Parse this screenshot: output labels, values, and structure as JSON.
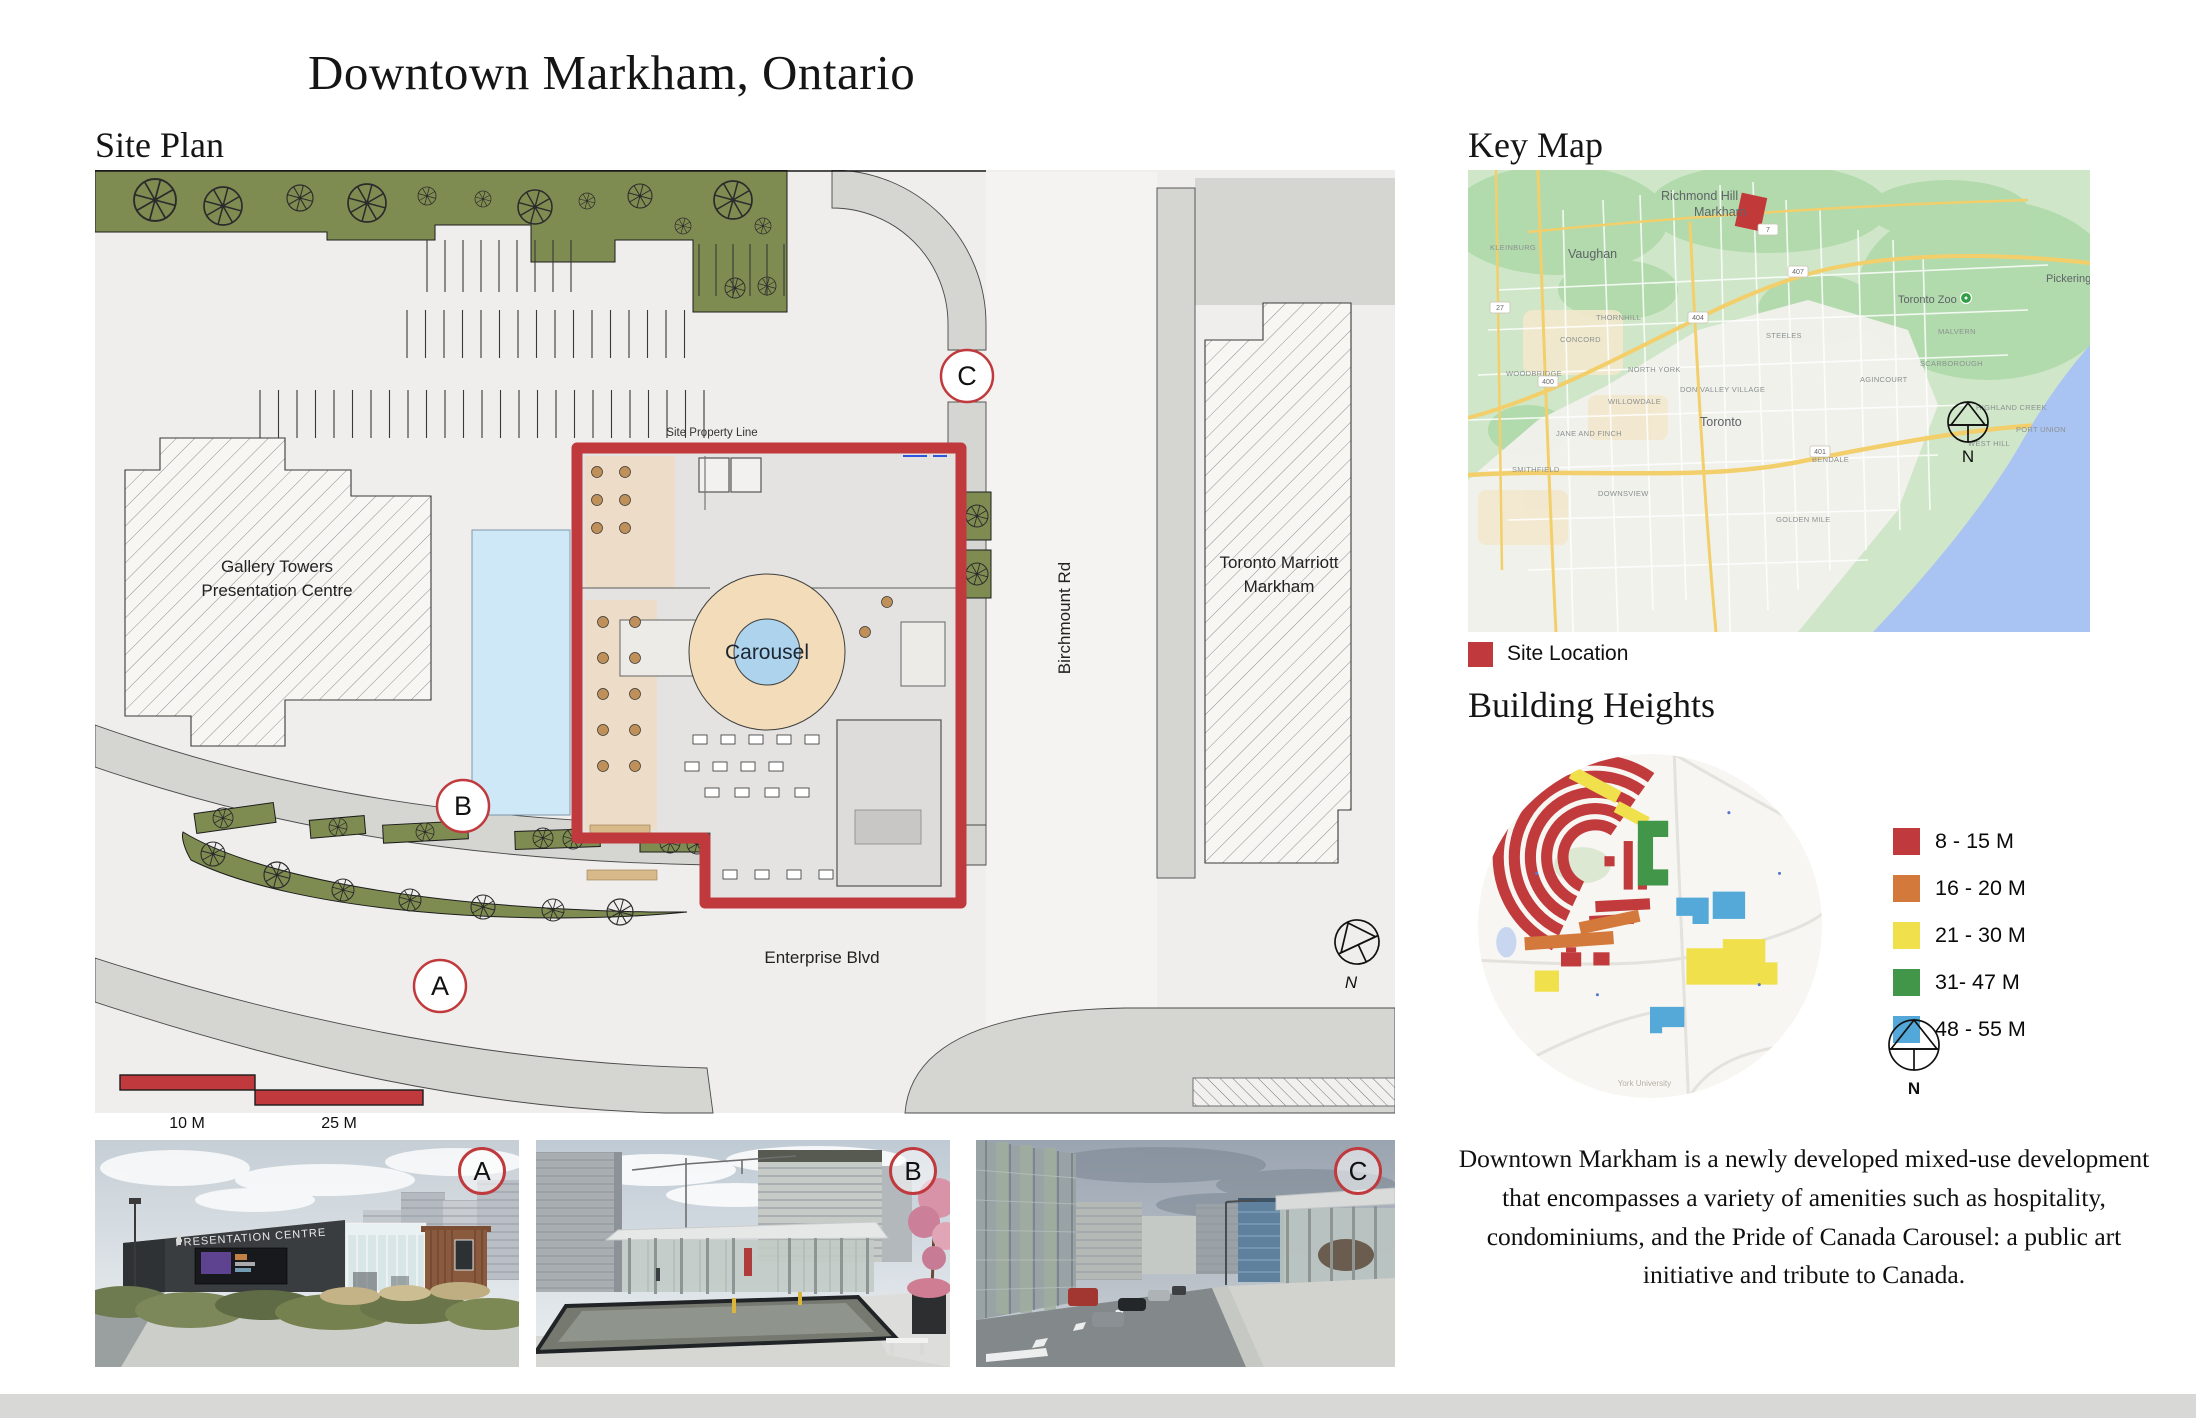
{
  "title": "Downtown Markham, Ontario",
  "site_plan": {
    "heading": "Site Plan",
    "labels": {
      "gallery1": "Gallery Towers",
      "gallery2": "Presentation Centre",
      "marriott1": "Toronto Marriott",
      "marriott2": "Markham",
      "carousel": "Carousel",
      "property_line": "Site Property Line",
      "birchmount": "Birchmount Rd",
      "enterprise": "Enterprise Blvd",
      "scale_10": "10 M",
      "scale_25": "25 M",
      "north": "N",
      "marker_a": "A",
      "marker_b": "B",
      "marker_c": "C"
    }
  },
  "key_map": {
    "heading": "Key Map",
    "site_location": "Site Location",
    "north": "N",
    "labels": [
      {
        "text": "Richmond Hill",
        "x": 193,
        "y": 30,
        "cls": "lg"
      },
      {
        "text": "Vaughan",
        "x": 100,
        "y": 88,
        "cls": "lg"
      },
      {
        "text": "Markham",
        "x": 226,
        "y": 46,
        "cls": "lg"
      },
      {
        "text": "Toronto Zoo",
        "x": 430,
        "y": 133,
        "cls": "md"
      },
      {
        "text": "Pickering",
        "x": 578,
        "y": 112,
        "cls": "md"
      },
      {
        "text": "Toronto",
        "x": 232,
        "y": 256,
        "cls": "lg"
      },
      {
        "text": "SCARBOROUGH",
        "x": 452,
        "y": 196,
        "cls": "sm"
      },
      {
        "text": "NORTH YORK",
        "x": 160,
        "y": 202,
        "cls": "sm"
      },
      {
        "text": "THORNHILL",
        "x": 128,
        "y": 150,
        "cls": "sm"
      },
      {
        "text": "WILLOWDALE",
        "x": 140,
        "y": 234,
        "cls": "sm"
      },
      {
        "text": "DON VALLEY VILLAGE",
        "x": 212,
        "y": 222,
        "cls": "sm"
      },
      {
        "text": "MALVERN",
        "x": 470,
        "y": 164,
        "cls": "sm"
      },
      {
        "text": "AGINCOURT",
        "x": 392,
        "y": 212,
        "cls": "sm"
      },
      {
        "text": "STEELES",
        "x": 298,
        "y": 168,
        "cls": "sm"
      },
      {
        "text": "KLEINBURG",
        "x": 22,
        "y": 80,
        "cls": "sm"
      },
      {
        "text": "WOODBRIDGE",
        "x": 38,
        "y": 206,
        "cls": "sm"
      },
      {
        "text": "CONCORD",
        "x": 92,
        "y": 172,
        "cls": "sm"
      },
      {
        "text": "JANE AND FINCH",
        "x": 88,
        "y": 266,
        "cls": "sm"
      },
      {
        "text": "DOWNSVIEW",
        "x": 130,
        "y": 326,
        "cls": "sm"
      },
      {
        "text": "SMITHFIELD",
        "x": 44,
        "y": 302,
        "cls": "sm"
      },
      {
        "text": "BENDALE",
        "x": 344,
        "y": 292,
        "cls": "sm"
      },
      {
        "text": "GOLDEN MILE",
        "x": 308,
        "y": 352,
        "cls": "sm"
      },
      {
        "text": "HIGHLAND CREEK",
        "x": 508,
        "y": 240,
        "cls": "sm"
      },
      {
        "text": "PORT UNION",
        "x": 548,
        "y": 262,
        "cls": "sm"
      },
      {
        "text": "WEST HILL",
        "x": 500,
        "y": 276,
        "cls": "sm"
      },
      {
        "text": "407",
        "x": 330,
        "y": 104,
        "cls": "badge"
      },
      {
        "text": "401",
        "x": 352,
        "y": 284,
        "cls": "badge"
      },
      {
        "text": "404",
        "x": 230,
        "y": 150,
        "cls": "badge"
      },
      {
        "text": "400",
        "x": 80,
        "y": 214,
        "cls": "badge"
      },
      {
        "text": "27",
        "x": 32,
        "y": 140,
        "cls": "badge"
      },
      {
        "text": "7",
        "x": 300,
        "y": 62,
        "cls": "badge"
      }
    ]
  },
  "building_heights": {
    "heading": "Building Heights",
    "north": "N",
    "map_label": "York University",
    "legend": [
      {
        "label": "8 - 15 M",
        "color": "#c0393c"
      },
      {
        "label": "16 - 20 M",
        "color": "#d4793c"
      },
      {
        "label": "21 - 30 M",
        "color": "#f0e04b"
      },
      {
        "label": "31- 47 M",
        "color": "#41964a"
      },
      {
        "label": "48 - 55 M",
        "color": "#54a8d9"
      }
    ]
  },
  "photos": [
    {
      "label": "A",
      "sign": "PRESENTATION CENTRE"
    },
    {
      "label": "B"
    },
    {
      "label": "C"
    }
  ],
  "description": "Downtown Markham is a newly developed mixed-use development that encompasses a variety of amenities such as hospitality, condominiums, and the Pride of Canada Carousel: a public art initiative and tribute to Canada."
}
